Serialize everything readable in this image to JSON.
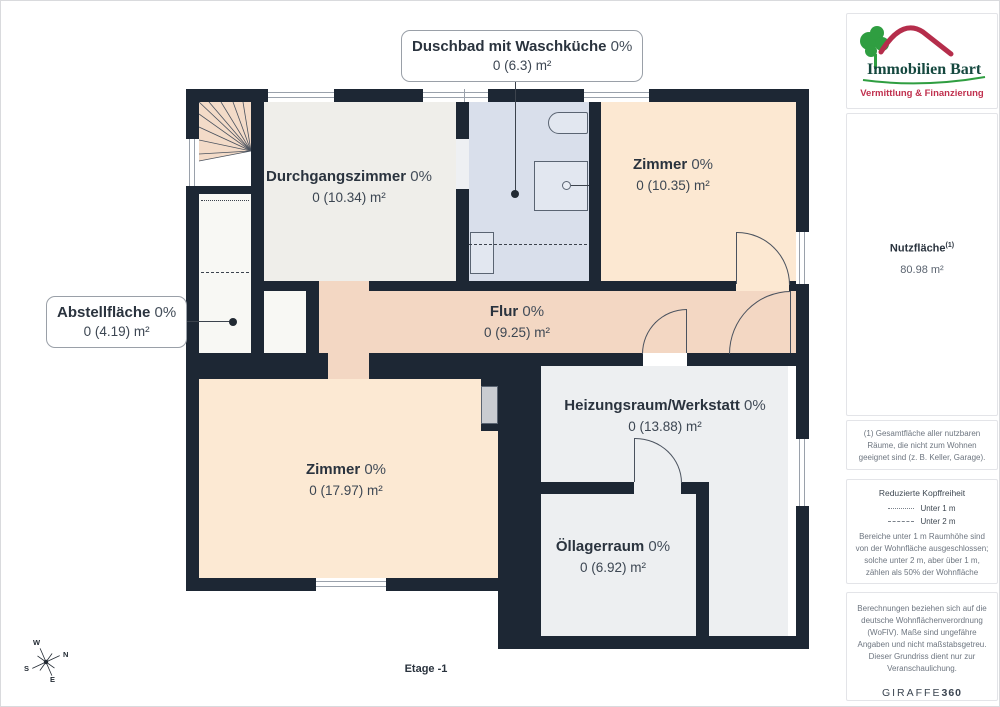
{
  "plan": {
    "floor_label": "Etage -1",
    "rooms": [
      {
        "name": "Duschbad mit Waschküche",
        "percent": "0%",
        "area": "0 (6.3) m²"
      },
      {
        "name": "Durchgangszimmer",
        "percent": "0%",
        "area": "0 (10.34) m²"
      },
      {
        "name": "Zimmer",
        "percent": "0%",
        "area": "0 (10.35) m²"
      },
      {
        "name": "Abstellfläche",
        "percent": "0%",
        "area": "0 (4.19) m²"
      },
      {
        "name": "Flur",
        "percent": "0%",
        "area": "0 (9.25) m²"
      },
      {
        "name": "Zimmer",
        "percent": "0%",
        "area": "0 (17.97) m²"
      },
      {
        "name": "Heizungsraum/Werkstatt",
        "percent": "0%",
        "area": "0 (13.88) m²"
      },
      {
        "name": "Öllagerraum",
        "percent": "0%",
        "area": "0 (6.92) m²"
      }
    ],
    "compass": {
      "n": "N",
      "s": "S",
      "e": "E",
      "w": "W"
    }
  },
  "sidebar": {
    "logo": {
      "title": "Immobilien Bart",
      "subtitle": "Vermittlung & Finanzierung"
    },
    "nutzflaeche": {
      "label": "Nutzfläche",
      "sup": "(1)",
      "value": "80.98 m²"
    },
    "footnote": "(1) Gesamtfläche aller nutzbaren Räume, die nicht zum Wohnen geeignet sind (z. B. Keller, Garage).",
    "legend": {
      "title": "Reduzierte Kopffreiheit",
      "items": [
        {
          "style": "dotted",
          "label": "Unter 1 m"
        },
        {
          "style": "dashed",
          "label": "Unter 2 m"
        }
      ],
      "note": "Bereiche unter 1 m Raumhöhe sind von der Wohnfläche ausgeschlossen; solche unter 2 m, aber über 1 m, zählen als 50% der Wohnfläche"
    },
    "disclaimer": "Berechnungen beziehen sich auf die deutsche Wohnflächenverordnung (WoFlV). Maße sind ungefähre Angaben und nicht maßstabsgetreu. Dieser Grundriss dient nur zur Veranschaulichung.",
    "brand": {
      "name": "GIRAFFE",
      "suffix": "360"
    }
  },
  "colors": {
    "wall": "#1d2734",
    "corridor": "#f3d7c3",
    "room_peach": "#fce8d2",
    "room_blue": "#d9dfeb",
    "room_gray": "#edeff1",
    "stairs_peach": "#f3dbc8",
    "logo_green": "#2f9e41",
    "logo_red": "#b52d4b",
    "logo_text": "#15483f",
    "brand_text": "#3a4450"
  }
}
